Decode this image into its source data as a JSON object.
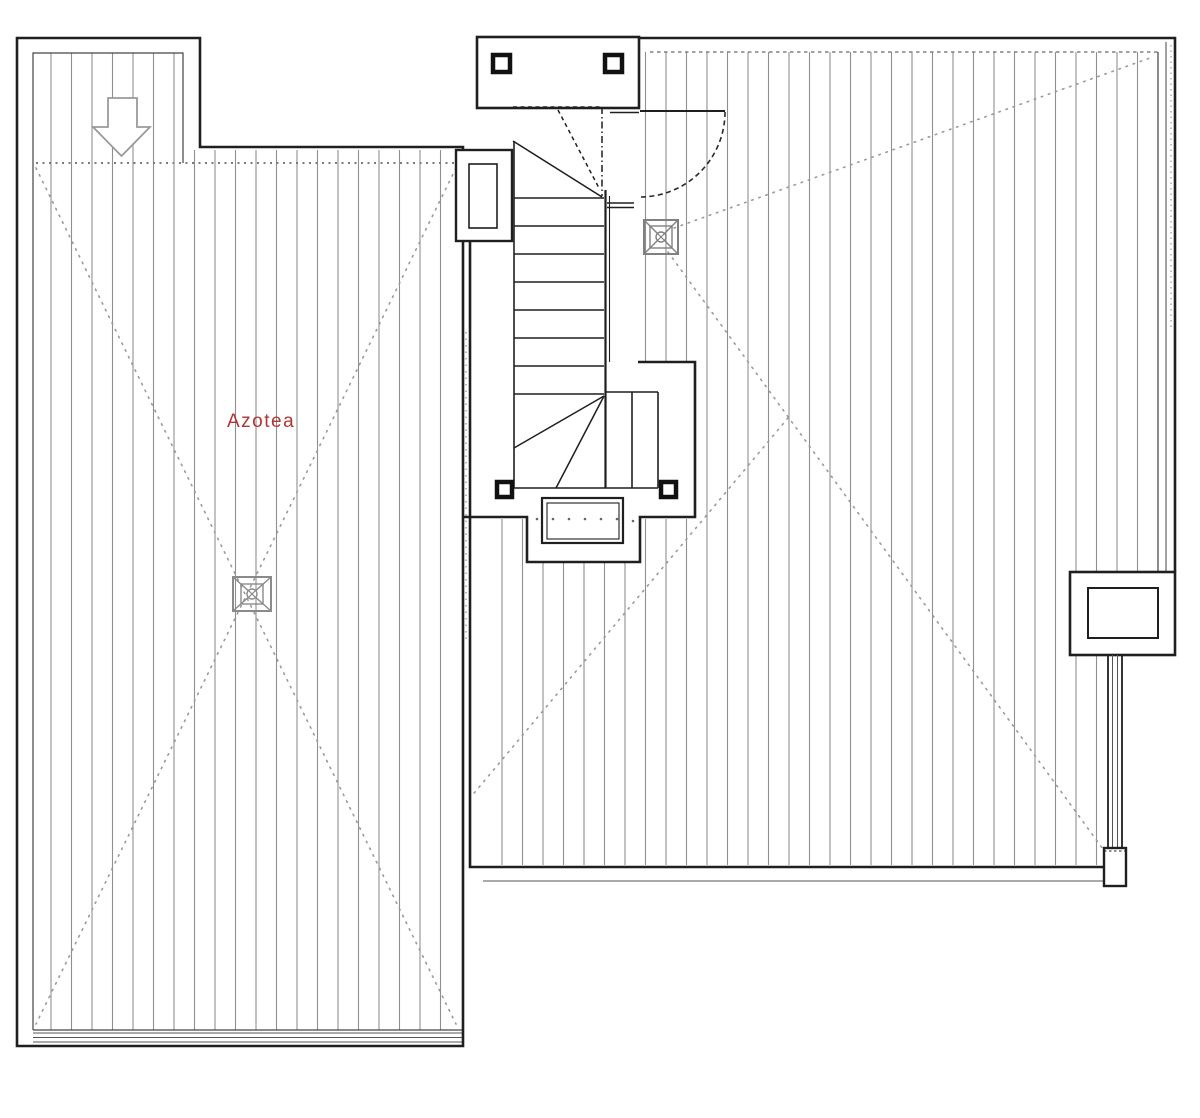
{
  "document": {
    "type": "architectural roof plan",
    "language": "es"
  },
  "labels": {
    "room": "Azotea"
  },
  "colors": {
    "background": "#ffffff",
    "linework": "#1f1f1f",
    "wall_inner": "#444444",
    "hatch": "#8f8f8f",
    "dotted_guides": "#9a9a9a",
    "room_label": "#b23535",
    "symbols": "#8a8a8a"
  },
  "elements": {
    "roof_sections": [
      {
        "name": "left-roof-terrace",
        "label": "Azotea",
        "hatch": "vertical",
        "slope_lines": "dotted-x"
      },
      {
        "name": "right-roof-terrace",
        "label": "",
        "hatch": "vertical",
        "slope_lines": "dotted-to-drain"
      }
    ],
    "symbols": [
      {
        "name": "roof-drain",
        "count": 2
      },
      {
        "name": "access-down-arrow",
        "count": 1
      },
      {
        "name": "stair-flight-with-winders",
        "count": 1
      },
      {
        "name": "door-swing",
        "count": 1
      },
      {
        "name": "stair-bulkhead-columns",
        "count": 4
      },
      {
        "name": "shaft-box",
        "count": 1
      },
      {
        "name": "skylight-curb",
        "count": 1
      },
      {
        "name": "rain-pipe",
        "count": 1
      },
      {
        "name": "planter-grille",
        "count": 1
      }
    ]
  }
}
